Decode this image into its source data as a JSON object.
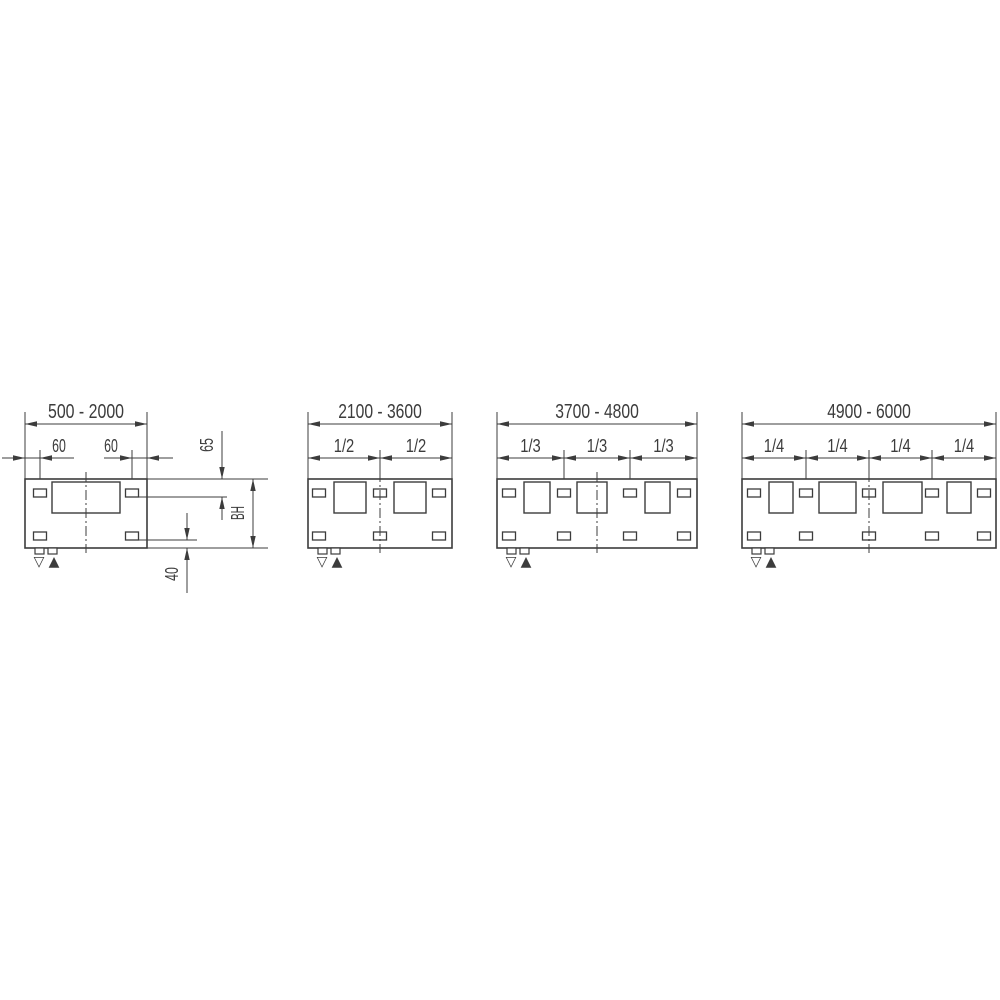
{
  "page": {
    "background": "#ffffff",
    "line_color": "#3c3c3c",
    "text_color": "#3c3c3c"
  },
  "diagram": {
    "panels": [
      {
        "name": "500-2000",
        "range_label": "500 - 2000",
        "sub_labels": [
          "60",
          "60"
        ],
        "symbols": [
          "▽",
          "▲"
        ],
        "side_dims": {
          "top_offset": "65",
          "build_height": "BH",
          "bottom_offset": "40"
        },
        "geometry": {
          "left": 25,
          "right": 147,
          "offset_dim": {
            "segments": [
              [
                2,
                74
              ],
              [
                104,
                173
              ]
            ],
            "arrows": [
              [
                25,
                "right"
              ],
              [
                40,
                "left"
              ],
              [
                132,
                "right"
              ],
              [
                147,
                "left"
              ]
            ],
            "bracket_lines": [
              40,
              132
            ],
            "label_centers": [
              59,
              111
            ]
          },
          "large_rects": [
            [
              52,
              120
            ]
          ],
          "bracket_centers": [
            40,
            132
          ]
        },
        "side_geometry": {
          "ext_lines": [
            [
              147,
              268,
              479
            ],
            [
              139,
              227,
              497
            ],
            [
              139,
              197,
              540
            ],
            [
              147,
              268,
              548
            ]
          ],
          "dim65": {
            "x": 222,
            "top_line": [
              431,
              479
            ],
            "bottom_line": [
              497,
              520
            ],
            "tips": [
              479,
              497
            ],
            "label_pos": [
              213,
              445
            ]
          },
          "dimBH": {
            "x": 253,
            "line": [
              479,
              548
            ],
            "tips": [
              479,
              548
            ],
            "label_pos": [
              244,
              513
            ]
          },
          "dim40": {
            "x": 187,
            "top_line": [
              513,
              540
            ],
            "bottom_line": [
              548,
              593
            ],
            "tips": [
              540,
              548
            ],
            "label_pos": [
              178,
              574
            ]
          }
        }
      },
      {
        "name": "2100-3600",
        "range_label": "2100 - 3600",
        "sub_labels": [
          "1/2",
          "1/2"
        ],
        "symbols": [
          "▽",
          "▲"
        ],
        "geometry": {
          "left": 308,
          "right": 452,
          "boundaries": [
            380
          ],
          "large_rects": [
            [
              334,
              366
            ],
            [
              394,
              426
            ]
          ],
          "bracket_centers": [
            319,
            380,
            439
          ]
        }
      },
      {
        "name": "3700-4800",
        "range_label": "3700 - 4800",
        "sub_labels": [
          "1/3",
          "1/3",
          "1/3"
        ],
        "symbols": [
          "▽",
          "▲"
        ],
        "geometry": {
          "left": 497,
          "right": 697,
          "boundaries": [
            564,
            630
          ],
          "large_rects": [
            [
              524,
              550
            ],
            [
              577,
              607
            ],
            [
              645,
              670
            ]
          ],
          "bracket_centers": [
            509,
            564,
            630,
            684
          ]
        }
      },
      {
        "name": "4900-6000",
        "range_label": "4900 - 6000",
        "sub_labels": [
          "1/4",
          "1/4",
          "1/4",
          "1/4"
        ],
        "symbols": [
          "▽",
          "▲"
        ],
        "geometry": {
          "left": 742,
          "right": 996,
          "boundaries": [
            806,
            869,
            932
          ],
          "large_rects": [
            [
              769,
              793
            ],
            [
              819,
              856
            ],
            [
              883,
              922
            ],
            [
              947,
              971
            ]
          ],
          "bracket_centers": [
            754,
            806,
            869,
            932,
            984
          ]
        }
      }
    ],
    "metrics": {
      "range_text_y": 418,
      "range_line_y": 424,
      "ext_top_y": 412,
      "sub_text_y": 452,
      "sub_line_y": 458,
      "panel_top": 479,
      "panel_bottom": 548,
      "large_rect_top": 482,
      "large_rect_bottom": 513,
      "top_bracket_top": 489,
      "bottom_bracket_top": 532,
      "bracket_w": 13,
      "bracket_h": 8,
      "boundary_line_top": 450,
      "center_line_top": 472,
      "center_line_bottom": 553,
      "tab_y": 548,
      "tab_w": 9,
      "tab_h": 6,
      "tab_offsets": [
        10,
        23
      ],
      "symbol_baseline_y": 566,
      "symbol_offsets": [
        14,
        29
      ],
      "arrow_len": 12,
      "arrow_halfwidth": 2.7
    }
  }
}
